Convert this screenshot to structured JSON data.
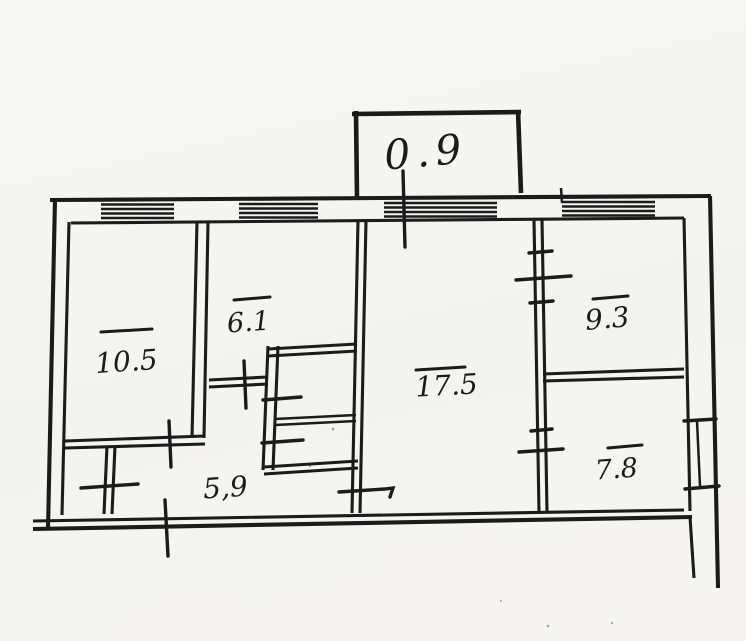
{
  "meta": {
    "kind": "hand-drawn apartment floor plan scan"
  },
  "colors": {
    "ink": "#1b1b1b",
    "paper": "#f5f4f0"
  },
  "rooms": {
    "balcony": "0.9",
    "room_top_left": "10.5",
    "room_center_left": "6.1",
    "room_center": "17.5",
    "room_top_right": "9.3",
    "room_bottom_right": "7.8",
    "hallway": "5,9"
  }
}
